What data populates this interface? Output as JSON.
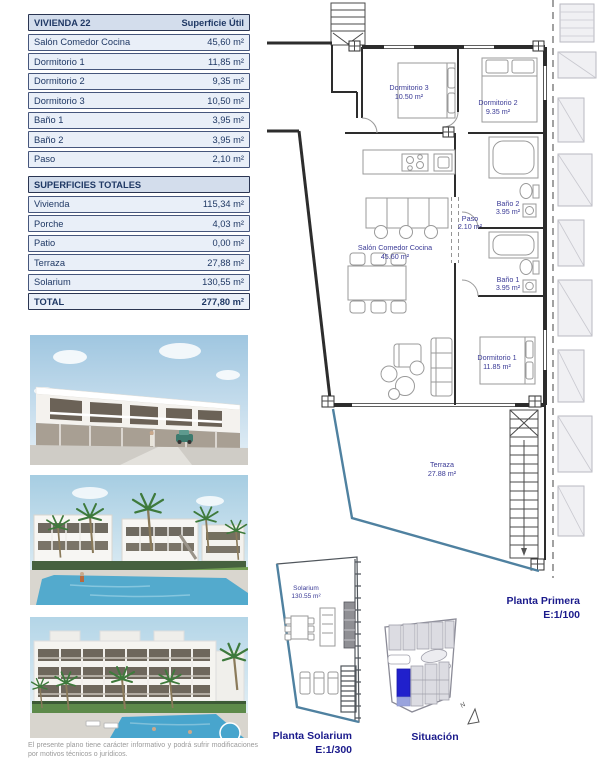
{
  "vivienda_table": {
    "title": "VIVIENDA 22",
    "value_header": "Superficie Útil",
    "rows": [
      {
        "label": "Salón Comedor Cocina",
        "value": "45,60 m²"
      },
      {
        "label": "Dormitorio 1",
        "value": "11,85 m²"
      },
      {
        "label": "Dormitorio 2",
        "value": "9,35 m²"
      },
      {
        "label": "Dormitorio 3",
        "value": "10,50 m²"
      },
      {
        "label": "Baño 1",
        "value": "3,95 m²"
      },
      {
        "label": "Baño 2",
        "value": "3,95 m²"
      },
      {
        "label": "Paso",
        "value": "2,10 m²"
      }
    ]
  },
  "totales_table": {
    "title": "SUPERFICIES TOTALES",
    "rows": [
      {
        "label": "Vivienda",
        "value": "115,34 m²"
      },
      {
        "label": "Porche",
        "value": "4,03 m²"
      },
      {
        "label": "Patio",
        "value": "0,00 m²"
      },
      {
        "label": "Terraza",
        "value": "27,88 m²"
      },
      {
        "label": "Solarium",
        "value": "130,55 m²"
      }
    ],
    "total": {
      "label": "TOTAL",
      "value": "277,80 m²"
    }
  },
  "floor_plan": {
    "caption": "Planta Primera",
    "scale": "E:1/100",
    "rooms": [
      {
        "name": "Dormitorio 3",
        "area": "10.50 m²"
      },
      {
        "name": "Dormitorio 2",
        "area": "9.35 m²"
      },
      {
        "name": "Baño 2",
        "area": "3.95 m²"
      },
      {
        "name": "Paso",
        "area": "2.10 m²"
      },
      {
        "name": "Baño 1",
        "area": "3.95 m²"
      },
      {
        "name": "Salón Comedor Cocina",
        "area": "45.60 m²"
      },
      {
        "name": "Dormitorio 1",
        "area": "11.85 m²"
      },
      {
        "name": "Terraza",
        "area": "27.88 m²"
      }
    ]
  },
  "solarium_plan": {
    "caption": "Planta Solarium",
    "scale": "E:1/300",
    "room": {
      "name": "Solarium",
      "area": "130.55 m²"
    }
  },
  "situacion": {
    "caption": "Situación",
    "north_label": "N"
  },
  "disclaimer": "El presente plano tiene carácter informativo y podrá sufrir modificaciones por motivos técnicos o jurídicos.",
  "colors": {
    "navy_text": "#1F3864",
    "table_header_bg": "#D3DDEC",
    "table_row_bg": "#E9EFF8",
    "caption_navy": "#1B1B8C",
    "terrace_line": "#4F81A0",
    "site_highlight": "#2020CC"
  }
}
